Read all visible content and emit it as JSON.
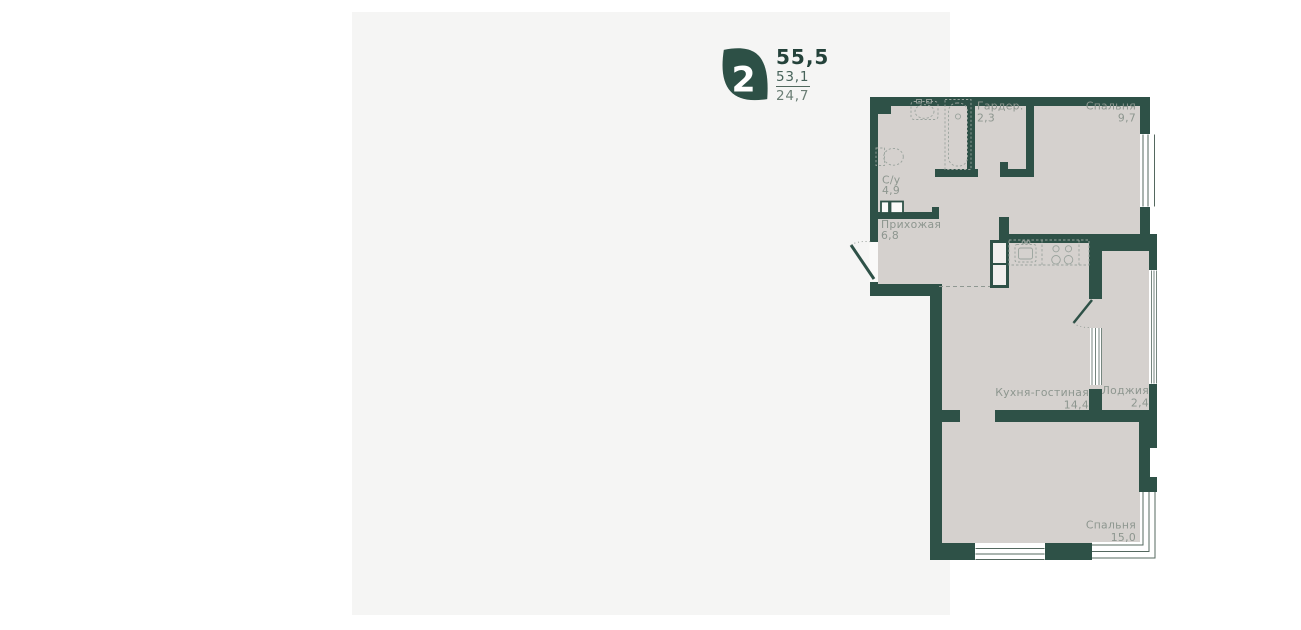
{
  "header": {
    "rooms_count": "2",
    "area_total": "55,5",
    "area_living": "53,1",
    "area_kitchen": "24,7"
  },
  "plan": {
    "rooms": [
      {
        "name": "С/у",
        "area": "4,9"
      },
      {
        "name": "Гардер.",
        "area": "2,3"
      },
      {
        "name": "Спальня",
        "area": "9,7"
      },
      {
        "name": "Прихожая",
        "area": "6,8"
      },
      {
        "name": "Кухня-гостиная",
        "area": "14,4"
      },
      {
        "name": "Лоджия",
        "area": "2,4"
      },
      {
        "name": "Спальня",
        "area": "15,0"
      }
    ]
  },
  "colors": {
    "wall": "#2e5147",
    "floor": "#d5d1ce",
    "card_bg": "#f5f5f4",
    "label": "#8d968f",
    "accent": "#2d5046"
  }
}
